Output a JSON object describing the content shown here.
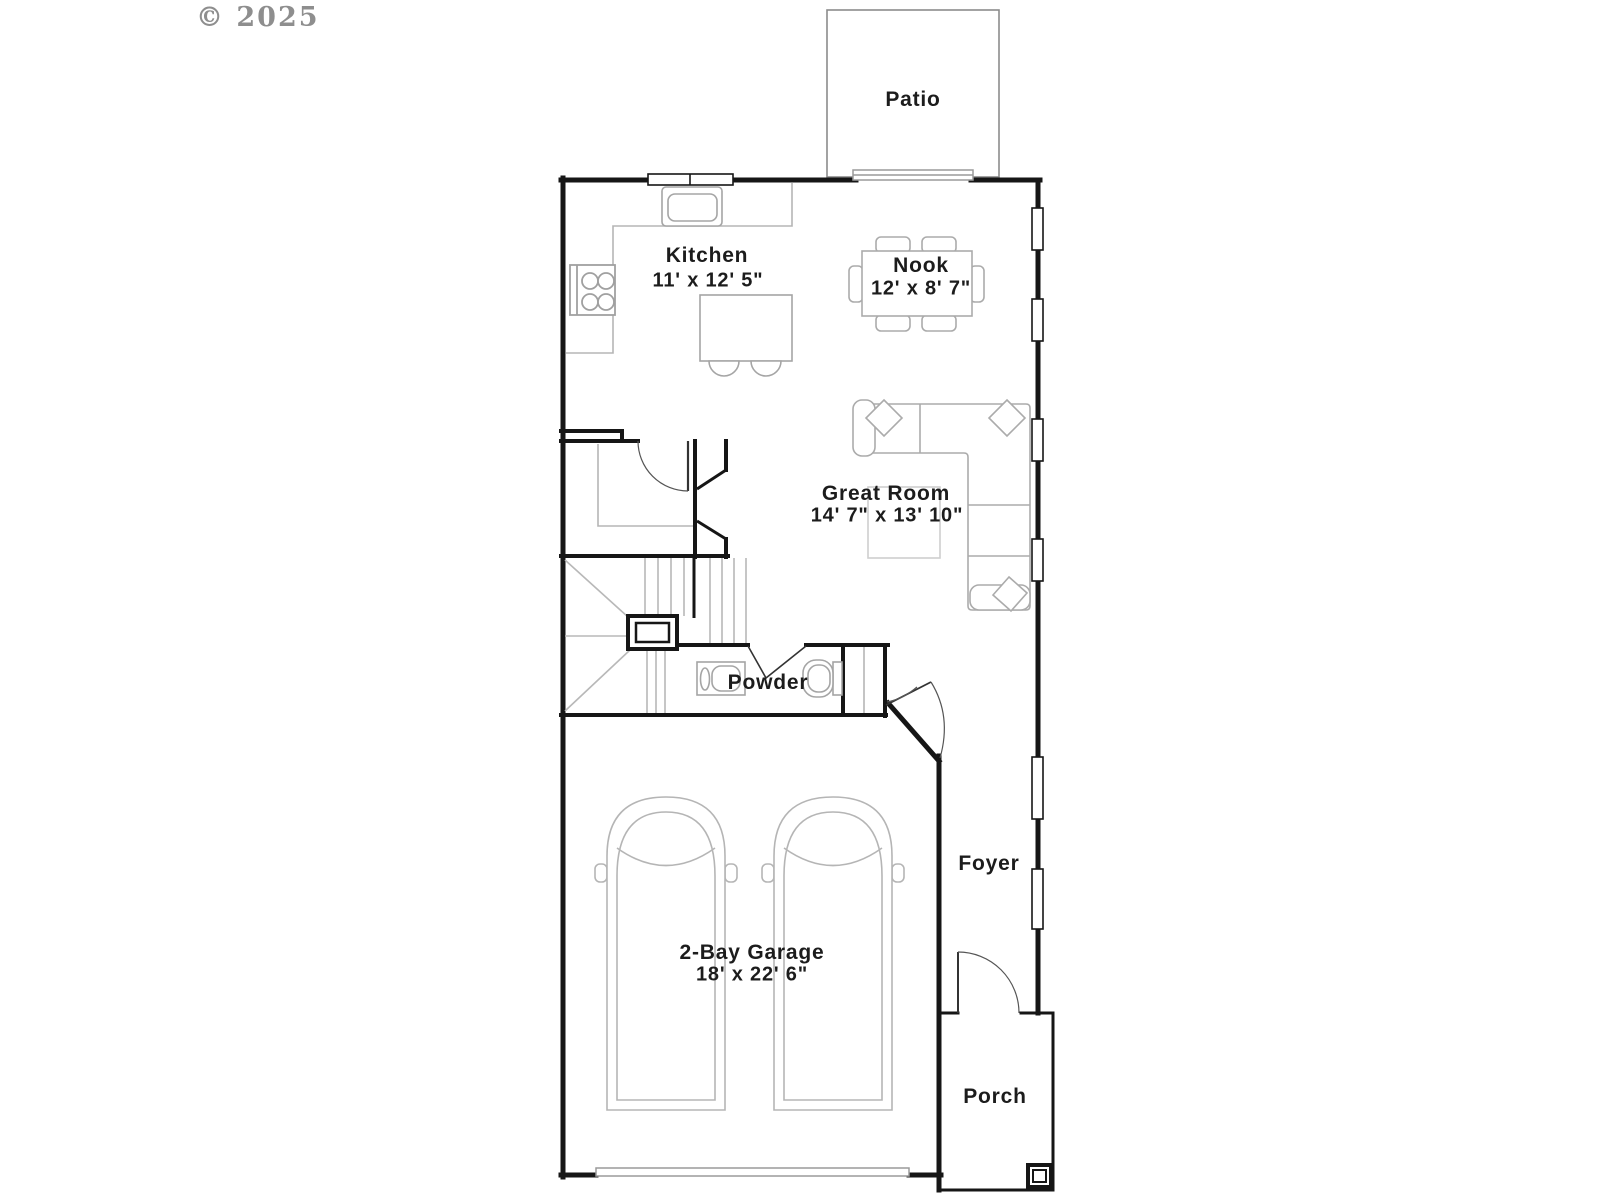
{
  "copyright": "© 2025",
  "labels": {
    "patio": {
      "name": "Patio"
    },
    "kitchen": {
      "name": "Kitchen",
      "dims": "11' x 12' 5\""
    },
    "nook": {
      "name": "Nook",
      "dims": "12' x 8' 7\""
    },
    "great_room": {
      "name": "Great Room",
      "dims": "14' 7\" x 13' 10\""
    },
    "powder": {
      "name": "Powder"
    },
    "foyer": {
      "name": "Foyer"
    },
    "garage": {
      "name": "2-Bay Garage",
      "dims": "18' x 22' 6\""
    },
    "porch": {
      "name": "Porch"
    }
  },
  "colors": {
    "wall": "#161616",
    "furniture": "#aaaaaa",
    "stairs": "#b8b8b8",
    "text": "#1c1c1c",
    "copyright": "#8e8e8e"
  }
}
